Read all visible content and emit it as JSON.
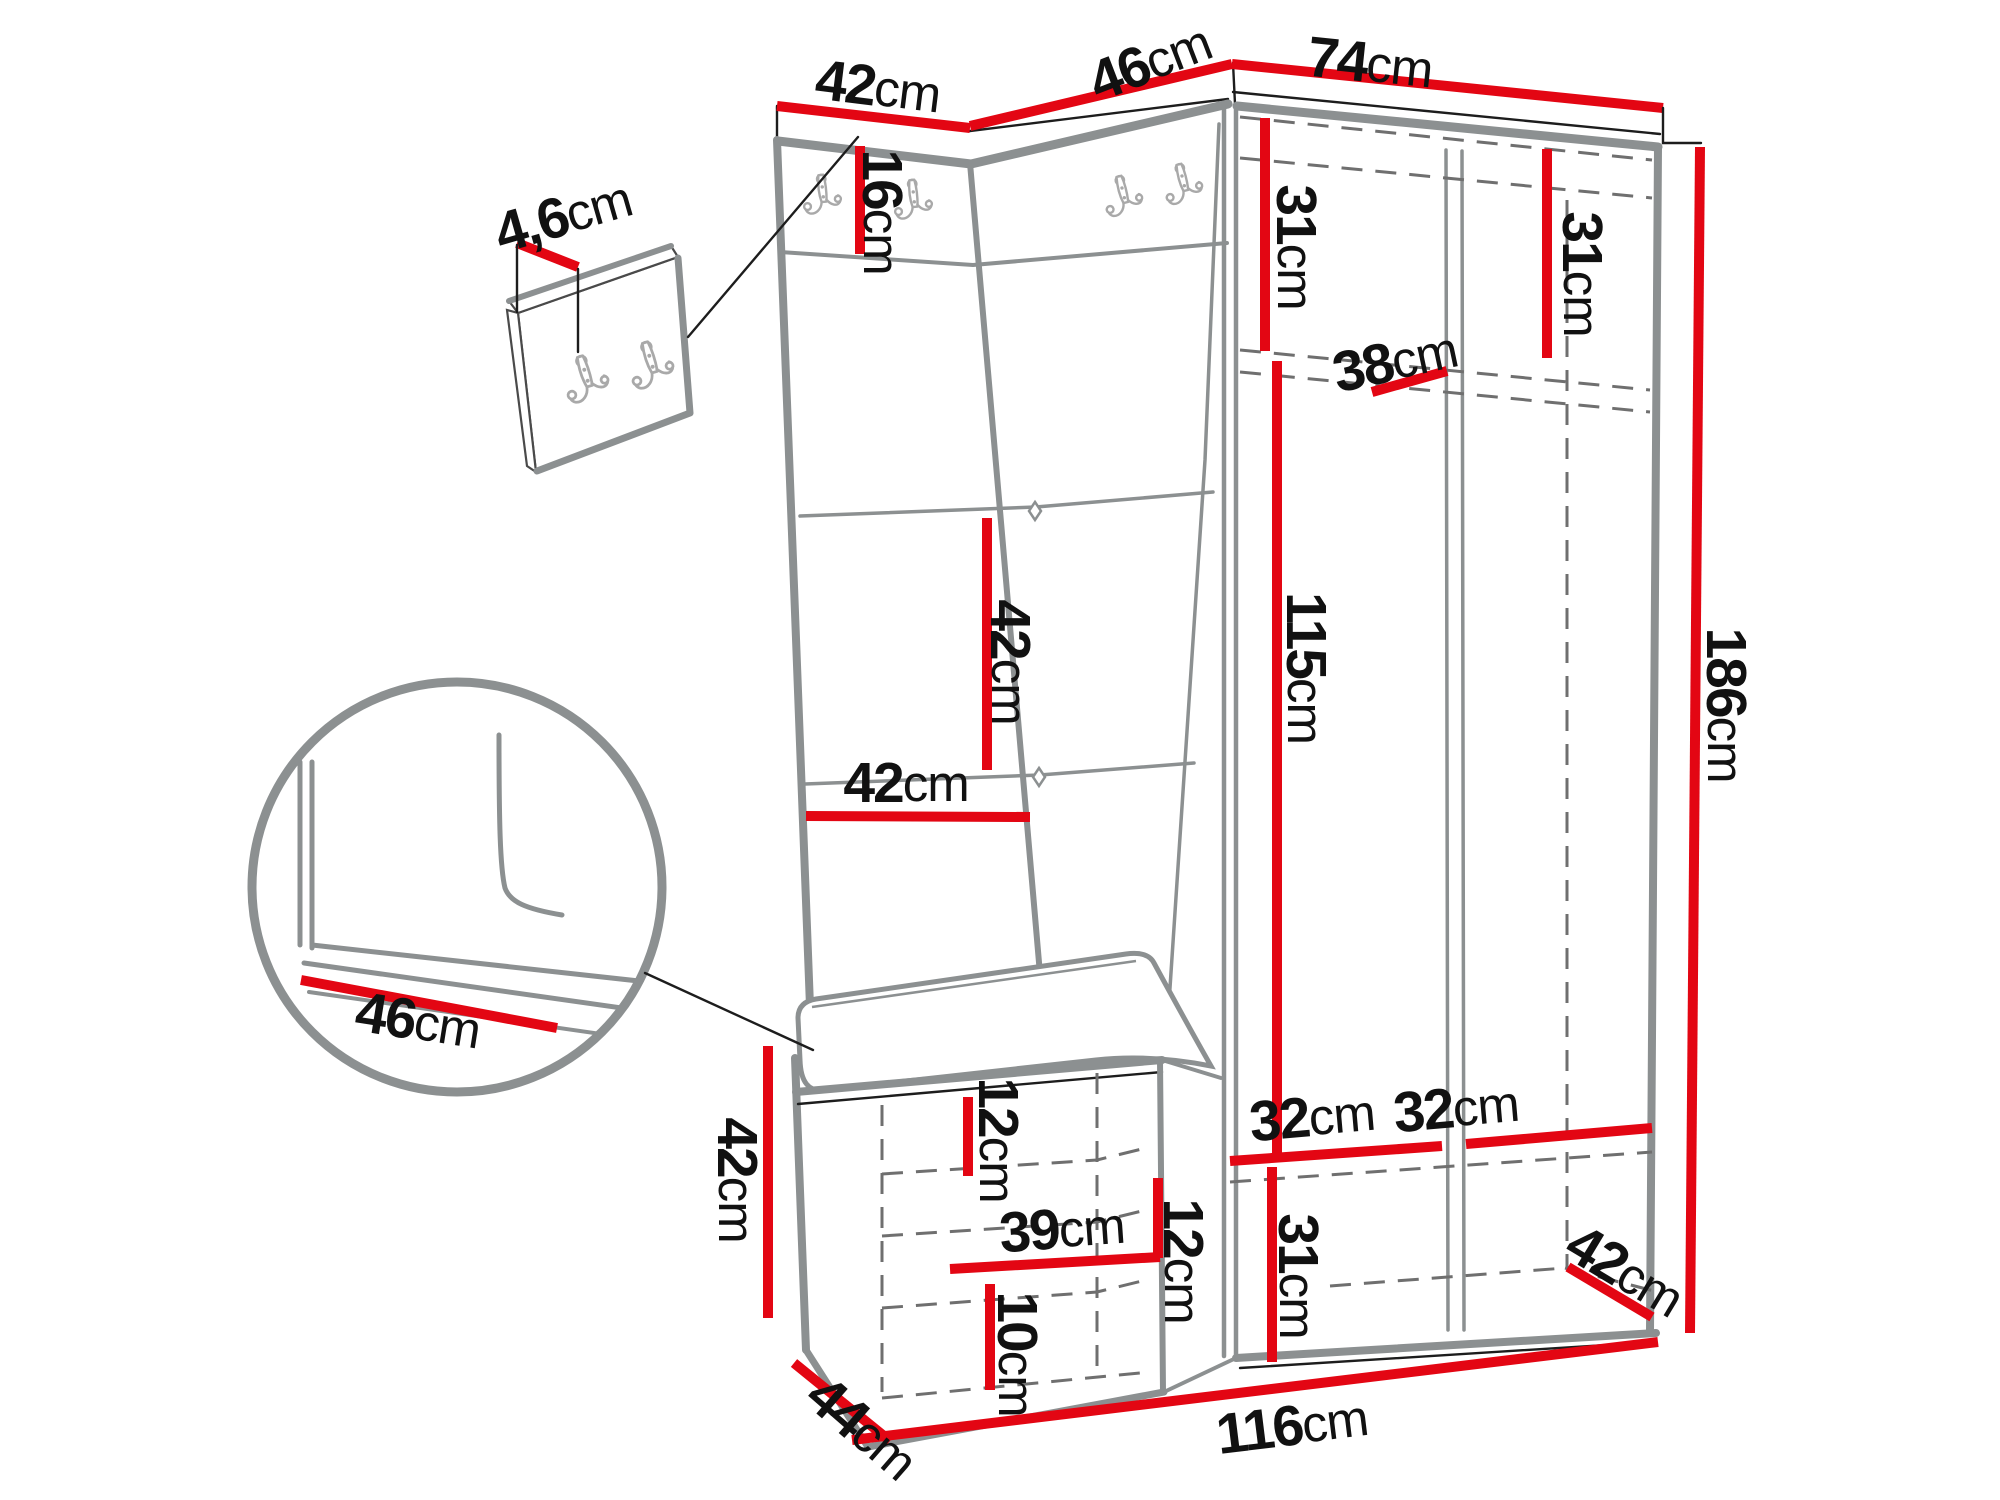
{
  "drawing_type": "furniture dimension diagram",
  "colors": {
    "dimension": "#e30613",
    "edge": "#8c9091",
    "dash": "#6f6f6f",
    "outline": "#1d1d1d",
    "hook": "#a9a9a9",
    "text": "#111111"
  },
  "dims": {
    "panel_top_width": {
      "num": "42",
      "unit": "cm"
    },
    "corner_top_width": {
      "num": "46",
      "unit": "cm"
    },
    "wardrobe_top_width": {
      "num": "74",
      "unit": "cm"
    },
    "panel_thickness": {
      "num": "4,6",
      "unit": "cm"
    },
    "hook_panel_height": {
      "num": "16",
      "unit": "cm"
    },
    "top_shelf_left_height": {
      "num": "31",
      "unit": "cm"
    },
    "top_shelf_right_height": {
      "num": "31",
      "unit": "cm"
    },
    "shelf_depth": {
      "num": "38",
      "unit": "cm"
    },
    "quilt_square_height": {
      "num": "42",
      "unit": "cm"
    },
    "panel_mid_width": {
      "num": "42",
      "unit": "cm"
    },
    "hanging_space_height": {
      "num": "115",
      "unit": "cm"
    },
    "total_height": {
      "num": "186",
      "unit": "cm"
    },
    "seat_depth_detail": {
      "num": "46",
      "unit": "cm"
    },
    "bench_height": {
      "num": "42",
      "unit": "cm"
    },
    "bench_top_gap": {
      "num": "12",
      "unit": "cm"
    },
    "bench_shelf_width": {
      "num": "39",
      "unit": "cm"
    },
    "bench_mid_gap": {
      "num": "12",
      "unit": "cm"
    },
    "bench_bottom_gap": {
      "num": "10",
      "unit": "cm"
    },
    "bottom_left_width": {
      "num": "32",
      "unit": "cm"
    },
    "bottom_right_width": {
      "num": "32",
      "unit": "cm"
    },
    "bottom_section_height": {
      "num": "31",
      "unit": "cm"
    },
    "bottom_depth_right": {
      "num": "42",
      "unit": "cm"
    },
    "bench_depth": {
      "num": "44",
      "unit": "cm"
    },
    "total_width": {
      "num": "116",
      "unit": "cm"
    }
  }
}
